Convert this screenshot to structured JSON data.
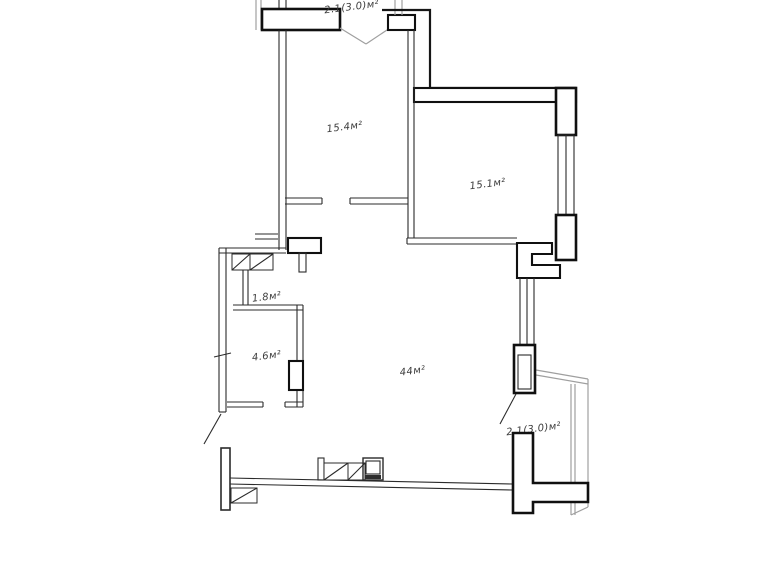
{
  "plan": {
    "type": "apartment-floor-plan",
    "labels": {
      "balcony_top": "2.1(3.0)м²",
      "room_1": "15.4м²",
      "room_2": "15.1м²",
      "closet": "1.8м²",
      "bathroom": "4.6м²",
      "living_kitchen": "44м²",
      "balcony_bottom": "2.1(3.0)м²"
    },
    "colors": {
      "wall": "#161616",
      "light_outline": "#9f9f9f",
      "text": "#3b3b3b",
      "background": "#ffffff"
    }
  }
}
